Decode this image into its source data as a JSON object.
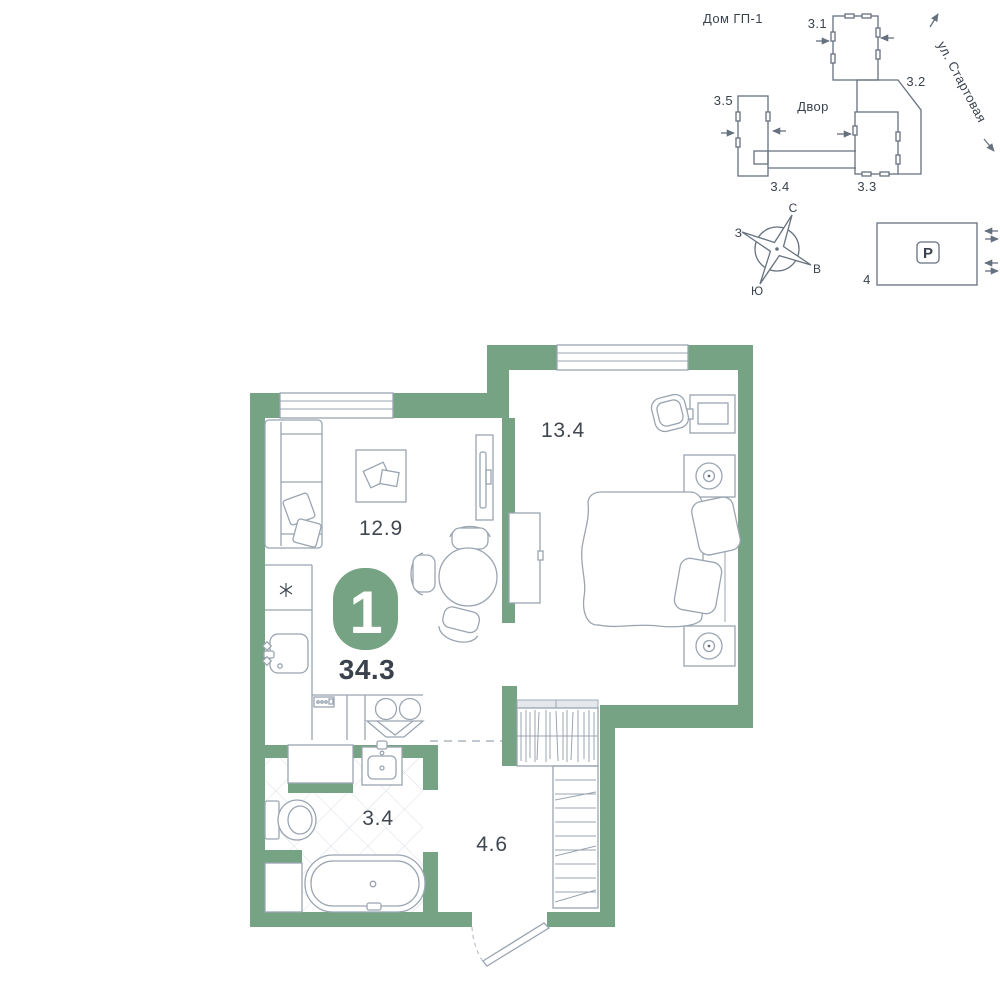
{
  "colors": {
    "wall": "#76A384",
    "furniture_outline": "#9AA5B1",
    "site_outline": "#66717F",
    "text_dark": "#3A424E",
    "area_label": "#3F4750",
    "tile_line": "#D9DEE3",
    "dashed_line": "#B9C1CA",
    "badge_fill": "#76A384",
    "badge_number": "#FFFFFF",
    "wardrobe_bar": "#E4E8EC"
  },
  "site_plan": {
    "title": "Дом ГП-1",
    "street_name": "ул. Стартовая",
    "courtyard_label": "Двор",
    "building_labels": {
      "b31": "3.1",
      "b32": "3.2",
      "b33": "3.3",
      "b34": "3.4",
      "b35": "3.5"
    },
    "compass": {
      "north": "С",
      "south": "Ю",
      "west": "З",
      "east": "В"
    },
    "parking": {
      "sign": "P",
      "lot_number": "4"
    }
  },
  "apartment": {
    "rooms_count": "1",
    "total_area": "34.3",
    "room_areas": {
      "living_kitchen": "12.9",
      "bedroom": "13.4",
      "bathroom": "3.4",
      "hallway": "4.6"
    }
  }
}
